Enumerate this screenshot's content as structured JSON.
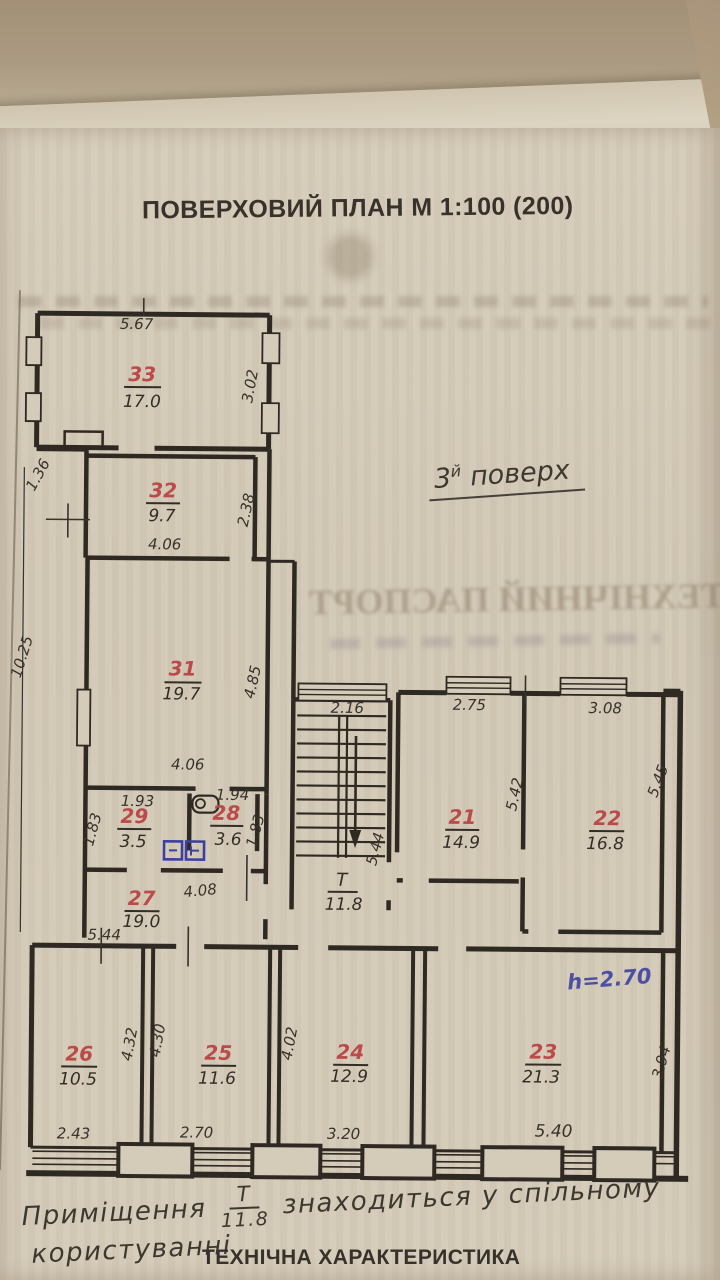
{
  "title": "ПОВЕРХОВИЙ ПЛАН М 1:100 (200)",
  "floor_note": {
    "num": "3",
    "sup": "й",
    "word": "поверх"
  },
  "height_note": "h=2.70",
  "bleedthrough_text": "ТЕХНІЧНИЙ ПАСПОРТ",
  "rooms": [
    {
      "number": "33",
      "area": "17.0"
    },
    {
      "number": "32",
      "area": "9.7"
    },
    {
      "number": "31",
      "area": "19.7"
    },
    {
      "number": "29",
      "area": "3.5"
    },
    {
      "number": "28",
      "area": "3.6"
    },
    {
      "number": "27",
      "area": "19.0"
    },
    {
      "number": "26",
      "area": "10.5"
    },
    {
      "number": "25",
      "area": "11.6"
    },
    {
      "number": "24",
      "area": "12.9"
    },
    {
      "number": "23",
      "area": "21.3"
    },
    {
      "number": "22",
      "area": "16.8"
    },
    {
      "number": "21",
      "area": "14.9"
    }
  ],
  "stair": {
    "label_top": "Т",
    "label_bottom": "11.8"
  },
  "dims": {
    "d5_67": "5.67",
    "d3_02": "3.02",
    "d1_36": "1.36",
    "d4_06_32": "4.06",
    "d2_38": "2.38",
    "d4_06_31": "4.06",
    "d4_85": "4.85",
    "d10_25": "10.25",
    "d1_93": "1.93",
    "d1_83_29": "1.83",
    "d1_94": "1.94",
    "d1_83_28": "1.83",
    "d4_08": "4.08",
    "d5_44_left": "5.44",
    "d2_16": "2.16",
    "d5_44_stair": "5.44",
    "d2_75": "2.75",
    "d5_42": "5.42",
    "d3_08": "3.08",
    "d5_45": "5.45",
    "d4_32": "4.32",
    "d4_30": "4.30",
    "d4_02": "4.02",
    "d2_43": "2.43",
    "d2_70": "2.70",
    "d3_20": "3.20",
    "d5_40": "5.40",
    "d3_94": "3.94"
  },
  "bottom_note": {
    "word1": "Приміщення",
    "frac_top": "Т",
    "frac_bottom": "11.8",
    "rest": "знаходиться у спільному",
    "line2": "користуванні"
  },
  "section_heading": "ТЕХНІЧНА ХАРАКТЕРИСТИКА",
  "colors": {
    "red_number": "#bc4a48",
    "blue_ink": "#4b50a5",
    "ink": "#2e2922",
    "paper": "#d3c9b7"
  }
}
